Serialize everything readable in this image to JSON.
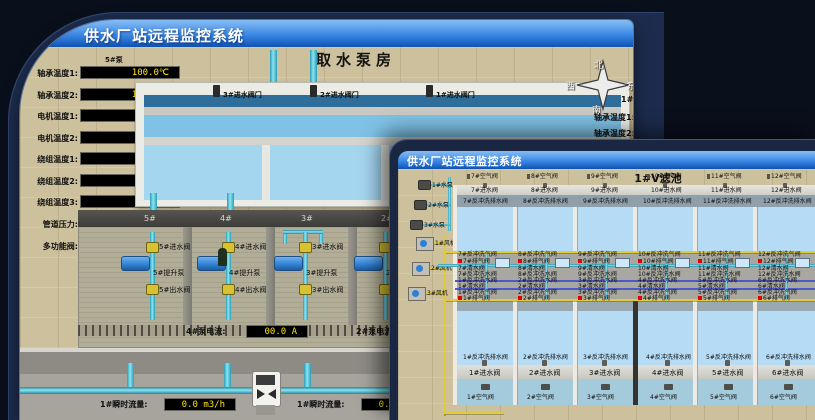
{
  "back_window": {
    "title": "供水厂站远程监控系统",
    "scene_title": "取水泵房",
    "pump_group_label": "5#泵",
    "readings": [
      {
        "label": "轴承温度1:",
        "value": "100.0℃"
      },
      {
        "label": "轴承温度2:",
        "value": "100.0℃"
      },
      {
        "label": "电机温度1:",
        "value": "18.1℃"
      },
      {
        "label": "电机温度2:",
        "value": "17.9℃"
      },
      {
        "label": "绕组温度1:",
        "value": "18.0℃"
      },
      {
        "label": "绕组温度2:",
        "value": "18.1℃"
      },
      {
        "label": "绕组温度3:",
        "value": "18.1℃"
      },
      {
        "label": "管道压力:",
        "value": "0.0007MPa"
      },
      {
        "label": "多功能阀:",
        "value": "0%"
      }
    ],
    "inlet_gates": [
      {
        "label": "3#进水阀门"
      },
      {
        "label": "2#进水阀门"
      },
      {
        "label": "1#进水阀门"
      }
    ],
    "compass": {
      "north": "北",
      "west": "西",
      "south": "南",
      "east": "东"
    },
    "right_panel": {
      "pump_group_label": "1#泵",
      "labels": [
        "轴承温度1:",
        "轴承温度2:"
      ]
    },
    "pump_bays": [
      {
        "bay": "5#",
        "inlet": "5#进水阀",
        "pump": "5#提升泵",
        "outlet": "5#出水阀"
      },
      {
        "bay": "4#",
        "inlet": "4#进水阀",
        "pump": "4#提升泵",
        "outlet": "4#出水阀"
      },
      {
        "bay": "3#",
        "inlet": "3#进水阀",
        "pump": "3#提升泵",
        "outlet": "3#出水阀"
      },
      {
        "bay": "2#",
        "inlet": "2#进水阀",
        "pump": "2#提升泵",
        "outlet": "2#出水阀"
      }
    ],
    "current_readouts": [
      {
        "label": "4#泵电流:",
        "value": "00.0 A"
      },
      {
        "label": "2#泵电流:"
      }
    ],
    "flow_readouts": [
      {
        "label": "1#瞬时流量:",
        "value": "0.0 m3/h"
      },
      {
        "label": "1#瞬时流量:",
        "value": "0.0 m3/h"
      }
    ]
  },
  "front_window": {
    "title": "供水厂站远程监控系统",
    "scene_title": "1#V滤池",
    "pumps": [
      {
        "label": "1#水泵"
      },
      {
        "label": "2#水泵"
      },
      {
        "label": "3#水泵"
      }
    ],
    "fans": [
      {
        "label": "1#风机"
      },
      {
        "label": "2#风机"
      },
      {
        "label": "3#风机"
      }
    ],
    "top_cells": [
      {
        "air": "7#空气阀",
        "inlet": "7#进水阀",
        "drain": "7#反冲洗排水阀"
      },
      {
        "air": "8#空气阀",
        "inlet": "8#进水阀",
        "drain": "8#反冲洗排水阀"
      },
      {
        "air": "9#空气阀",
        "inlet": "9#进水阀",
        "drain": "9#反冲洗排水阀"
      },
      {
        "air": "10#空气阀",
        "inlet": "10#进水阀",
        "drain": "10#反冲洗排水阀"
      },
      {
        "air": "11#空气阀",
        "inlet": "11#进水阀",
        "drain": "11#反冲洗排水阀"
      },
      {
        "air": "12#空气阀",
        "inlet": "12#进水阀",
        "drain": "12#反冲洗排水阀"
      }
    ],
    "bottom_cells": [
      {
        "drain": "1#反冲洗排水阀",
        "inlet": "1#进水阀",
        "air": "1#空气阀"
      },
      {
        "drain": "2#反冲洗排水阀",
        "inlet": "2#进水阀",
        "air": "2#空气阀"
      },
      {
        "drain": "3#反冲洗排水阀",
        "inlet": "3#进水阀",
        "air": "3#空气阀"
      },
      {
        "drain": "4#反冲洗排水阀",
        "inlet": "4#进水阀",
        "air": "4#空气阀"
      },
      {
        "drain": "5#反冲洗排水阀",
        "inlet": "5#进水阀",
        "air": "5#空气阀"
      },
      {
        "drain": "6#反冲洗排水阀",
        "inlet": "6#进水阀",
        "air": "6#空气阀"
      }
    ],
    "gallery_columns": [
      {
        "t_bw_air": "7#反冲洗气阀",
        "t_exhaust": "7#排气阀",
        "t_clean": "7#清水阀",
        "t_bw_water": "7#反冲洗水阀",
        "b_bw_water": "1#反冲洗水阀",
        "b_clean": "1#清水阀",
        "b_bw_air": "1#反冲洗气阀",
        "b_exhaust": "1#排气阀"
      },
      {
        "t_bw_air": "8#反冲洗气阀",
        "t_exhaust": "8#排气阀",
        "t_clean": "8#清水阀",
        "t_bw_water": "8#反冲洗水阀",
        "b_bw_water": "2#反冲洗水阀",
        "b_clean": "2#清水阀",
        "b_bw_air": "2#反冲洗气阀",
        "b_exhaust": "2#排气阀"
      },
      {
        "t_bw_air": "9#反冲洗气阀",
        "t_exhaust": "9#排气阀",
        "t_clean": "9#清水阀",
        "t_bw_water": "9#反冲洗水阀",
        "b_bw_water": "3#反冲洗水阀",
        "b_clean": "3#清水阀",
        "b_bw_air": "3#反冲洗气阀",
        "b_exhaust": "3#排气阀"
      },
      {
        "t_bw_air": "10#反冲洗气阀",
        "t_exhaust": "10#排气阀",
        "t_clean": "10#清水阀",
        "t_bw_water": "10#反冲洗水阀",
        "b_bw_water": "4#反冲洗水阀",
        "b_clean": "4#清水阀",
        "b_bw_air": "4#反冲洗气阀",
        "b_exhaust": "4#排气阀"
      },
      {
        "t_bw_air": "11#反冲洗气阀",
        "t_exhaust": "11#排气阀",
        "t_clean": "11#清水阀",
        "t_bw_water": "11#反冲洗水阀",
        "b_bw_water": "5#反冲洗水阀",
        "b_clean": "5#清水阀",
        "b_bw_air": "5#反冲洗气阀",
        "b_exhaust": "5#排气阀"
      },
      {
        "t_bw_air": "12#反冲洗气阀",
        "t_exhaust": "12#排气阀",
        "t_clean": "12#清水阀",
        "t_bw_water": "12#反冲洗水阀",
        "b_bw_water": "6#反冲洗水阀",
        "b_clean": "6#清水阀",
        "b_bw_air": "6#反冲洗气阀",
        "b_exhaust": "6#排气阀"
      }
    ]
  },
  "icons": {
    "compass": "compass-rose",
    "flow_meter": "bowtie-flow-meter",
    "valve": "gate-valve",
    "pump": "centrifugal-pump",
    "fan": "blower-fan"
  },
  "colors": {
    "titlebar_top": "#87bef5",
    "titlebar_bottom": "#0f52b2",
    "value_text": "#ffe400",
    "readout_bg": "#000000",
    "pipe_cyan": "#3fb9d2",
    "pipe_yellow": "#e0cb3c",
    "pipe_blue": "#4b5ac9",
    "water": "#b5dcf4",
    "alarm_red": "#e20000",
    "floor_tan": "#ccc09d"
  }
}
